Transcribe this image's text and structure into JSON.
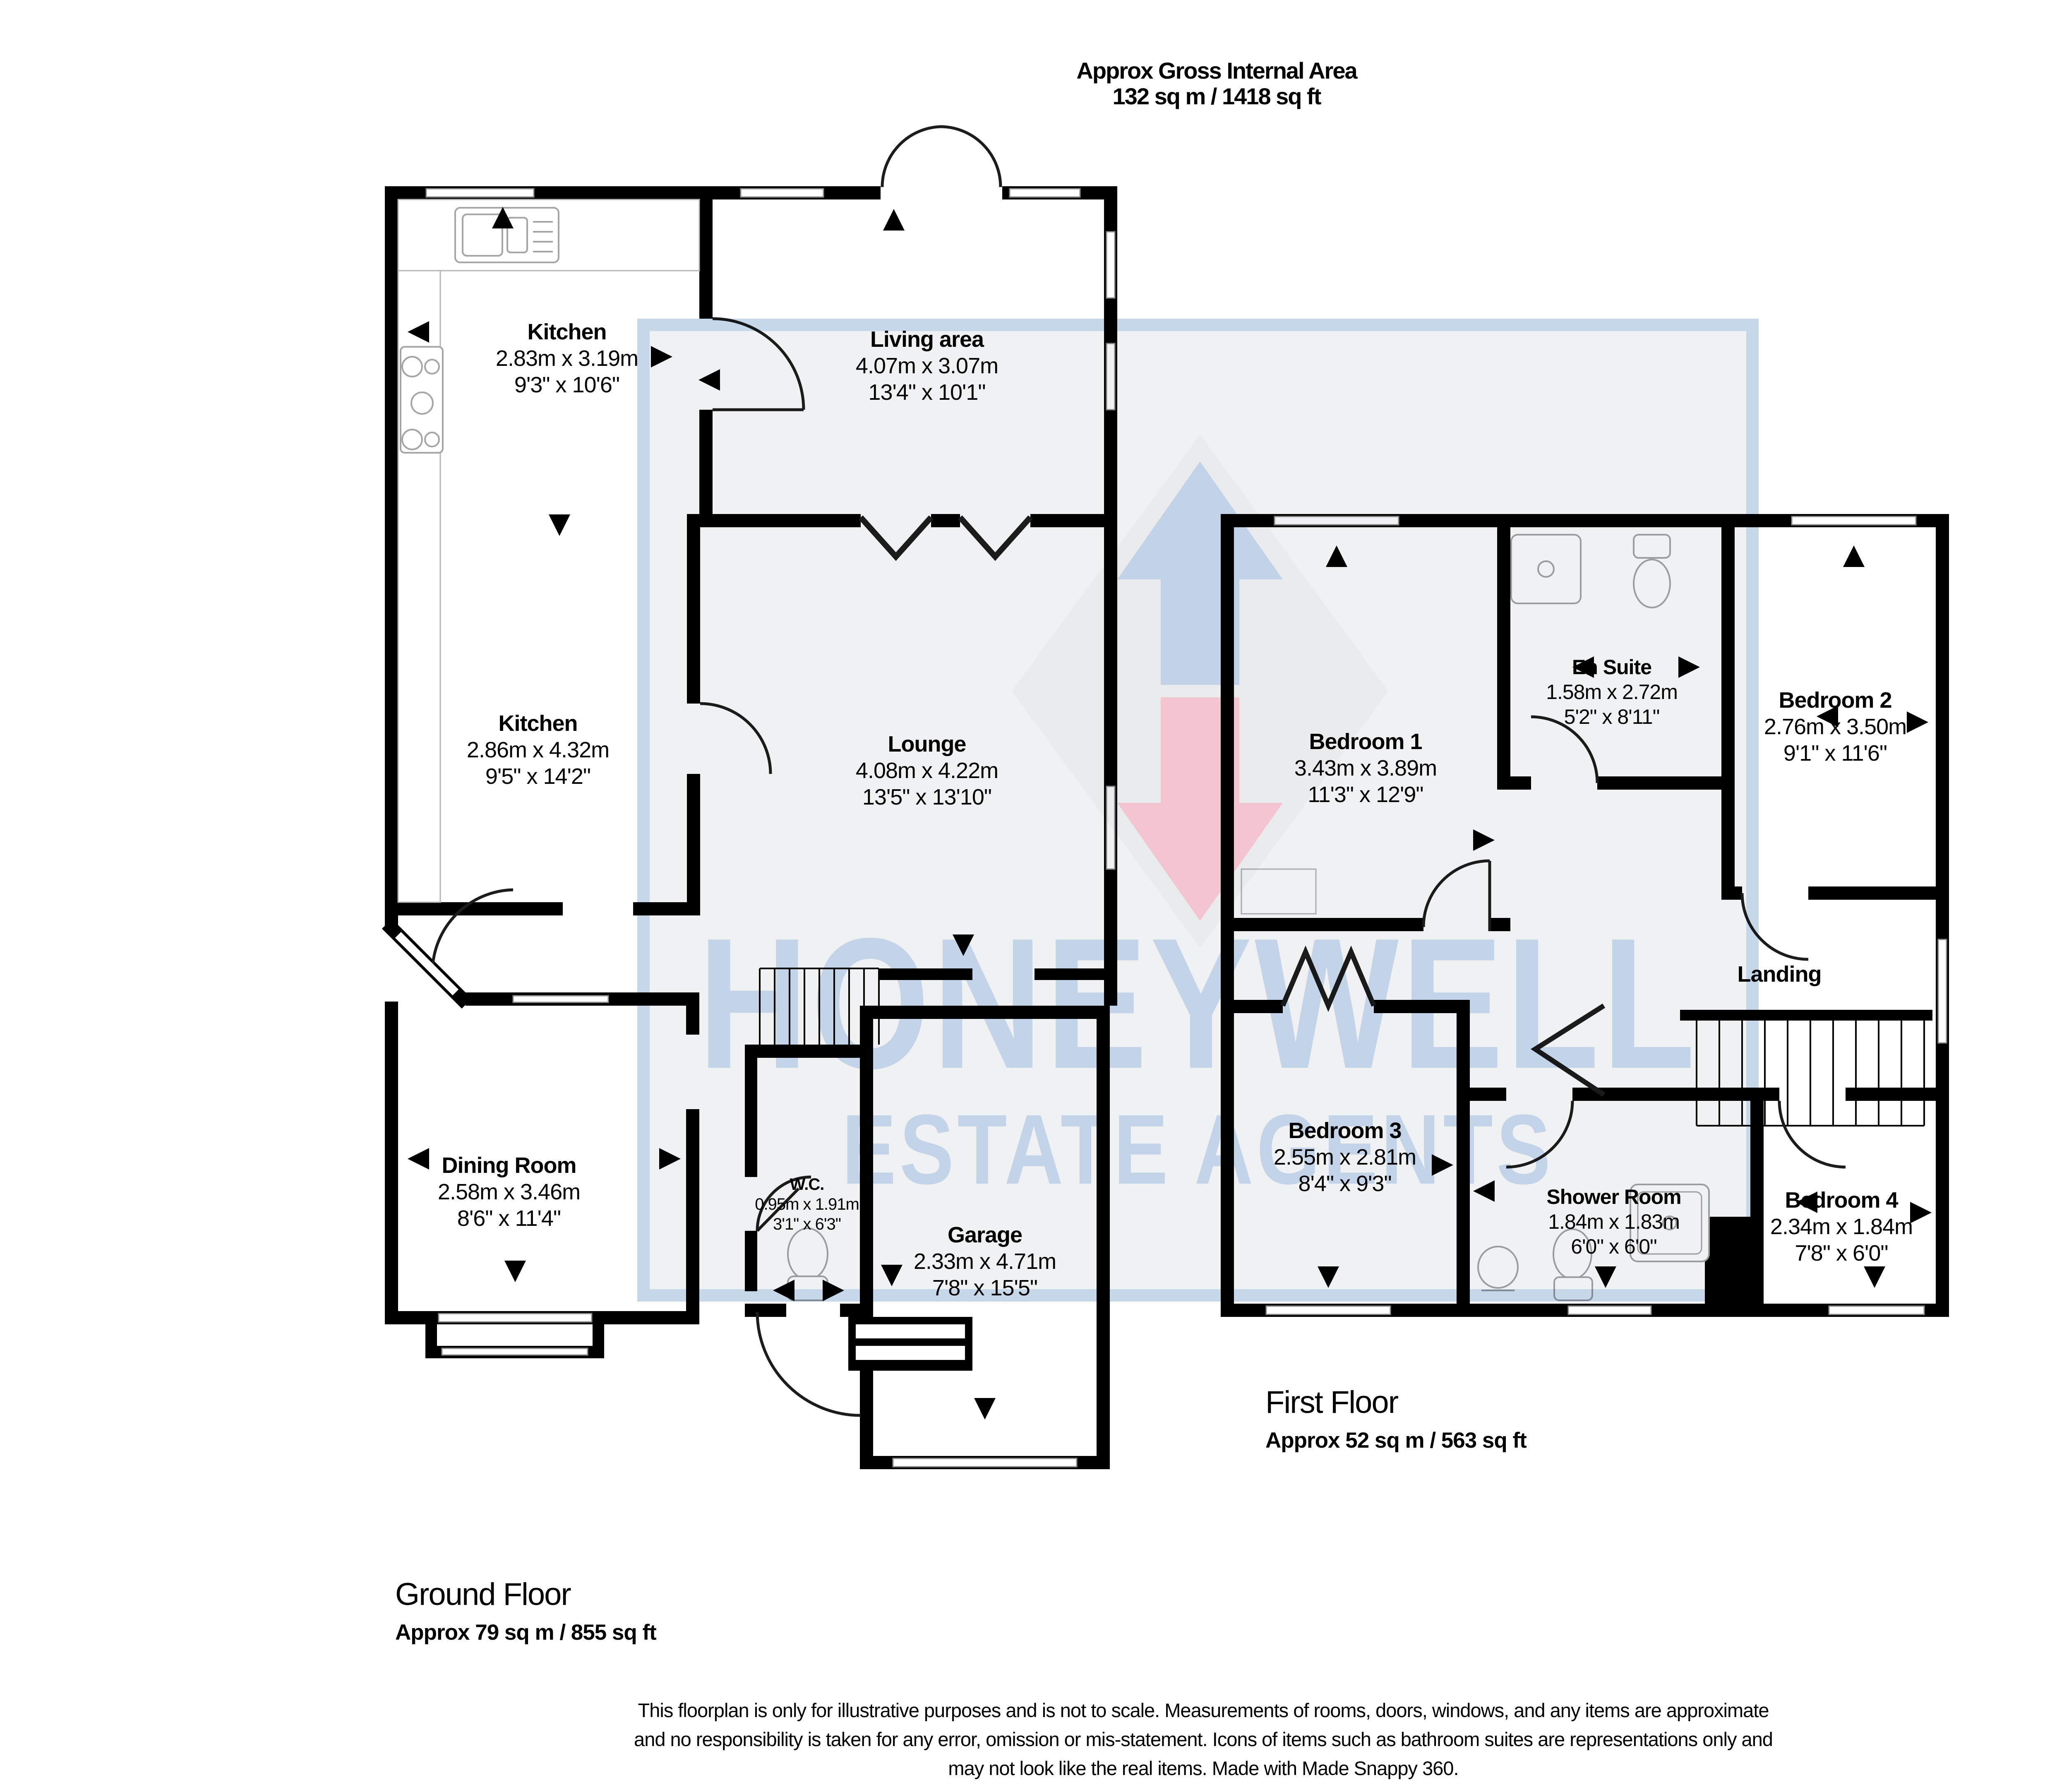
{
  "header": {
    "title_line1": "Approx Gross Internal Area",
    "title_line2": "132 sq m / 1418 sq ft"
  },
  "compass": {
    "north": "N",
    "south": "S",
    "east": "E",
    "west": "W"
  },
  "watermark": {
    "name": "HONEYWELL",
    "tagline": "ESTATE AGENTS"
  },
  "ground_floor": {
    "caption": "Ground Floor",
    "area": "Approx 79 sq m / 855 sq ft",
    "rooms": {
      "kitchen_top": {
        "name": "Kitchen",
        "metric": "2.83m x 3.19m",
        "imperial": "9'3\" x 10'6\""
      },
      "living_area": {
        "name": "Living area",
        "metric": "4.07m x 3.07m",
        "imperial": "13'4\" x 10'1\""
      },
      "kitchen_side": {
        "name": "Kitchen",
        "metric": "2.86m x 4.32m",
        "imperial": "9'5\" x 14'2\""
      },
      "lounge": {
        "name": "Lounge",
        "metric": "4.08m x 4.22m",
        "imperial": "13'5\" x 13'10\""
      },
      "dining_room": {
        "name": "Dining Room",
        "metric": "2.58m x 3.46m",
        "imperial": "8'6\" x 11'4\""
      },
      "wc": {
        "name": "W.C.",
        "metric": "0.95m x 1.91m",
        "imperial": "3'1\" x 6'3\""
      },
      "garage": {
        "name": "Garage",
        "metric": "2.33m x 4.71m",
        "imperial": "7'8\" x 15'5\""
      }
    }
  },
  "first_floor": {
    "caption": "First Floor",
    "area": "Approx 52 sq m / 563 sq ft",
    "rooms": {
      "bedroom1": {
        "name": "Bedroom 1",
        "metric": "3.43m x 3.89m",
        "imperial": "11'3\" x 12'9\""
      },
      "en_suite": {
        "name": "En Suite",
        "metric": "1.58m x 2.72m",
        "imperial": "5'2\" x 8'11\""
      },
      "bedroom2": {
        "name": "Bedroom 2",
        "metric": "2.76m x 3.50m",
        "imperial": "9'1\" x 11'6\""
      },
      "landing": {
        "name": "Landing"
      },
      "bedroom3": {
        "name": "Bedroom 3",
        "metric": "2.55m x 2.81m",
        "imperial": "8'4\" x 9'3\""
      },
      "shower_room": {
        "name": "Shower Room",
        "metric": "1.84m x 1.83m",
        "imperial": "6'0\" x 6'0\""
      },
      "bedroom4": {
        "name": "Bedroom 4",
        "metric": "2.34m x 1.84m",
        "imperial": "7'8\" x 6'0\""
      }
    }
  },
  "disclaimer": {
    "line1": "This floorplan is only for illustrative purposes and is not to scale. Measurements of rooms, doors, windows, and any items are approximate",
    "line2": "and no responsibility is taken for any error, omission or mis-statement. Icons of items such as bathroom suites are representations only and",
    "line3": "may not look like the real items. Made with Made Snappy 360."
  },
  "icons": {
    "compass": "compass-rose",
    "logo_up_arrow": "watermark-up-arrow",
    "logo_down_arrow": "watermark-down-arrow"
  },
  "colors": {
    "wall": "#000000",
    "watermark_blue": "#c3d4e8",
    "watermark_pink": "#f2c5d0",
    "compass_dark": "#34383c"
  }
}
